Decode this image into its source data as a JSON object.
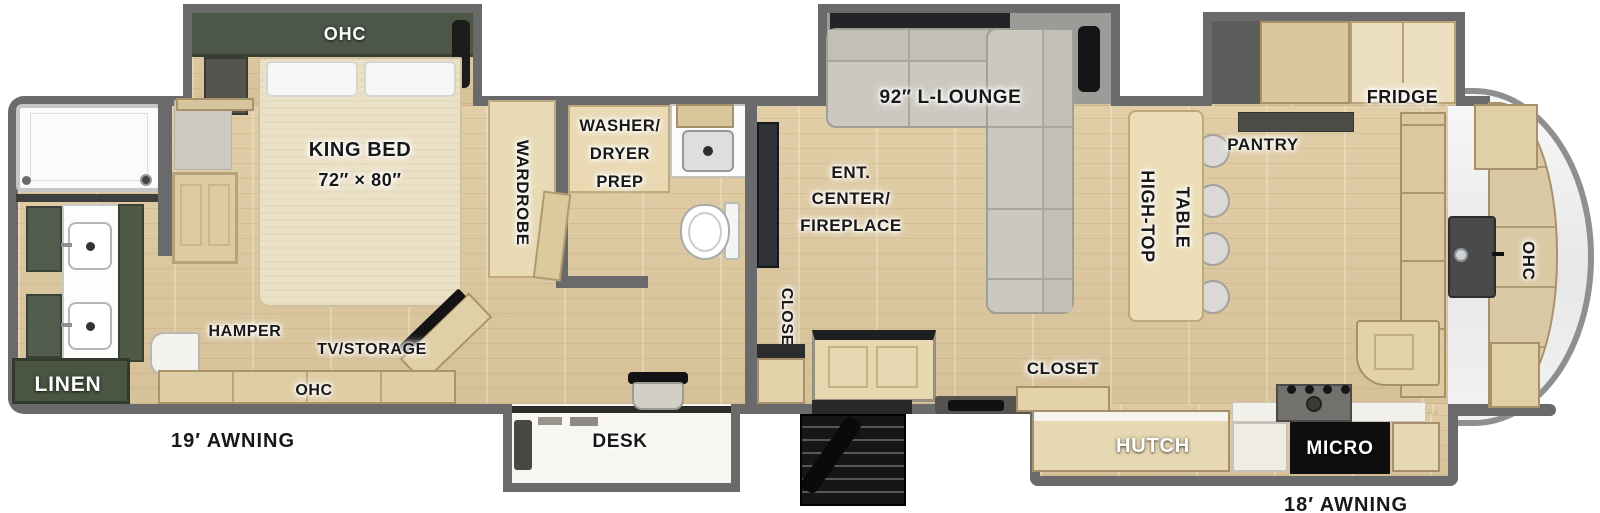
{
  "title": "RV fifth-wheel floor plan",
  "labels": {
    "bedroom_ohc": "OHC",
    "king_bed": {
      "line1": "KING BED",
      "line2": "72″ × 80″"
    },
    "wardrobe": "WARDROBE",
    "washer_dryer": {
      "line1": "WASHER/",
      "line2": "DRYER",
      "line3": "PREP"
    },
    "hamper": "HAMPER",
    "tv_storage": "TV/STORAGE",
    "ohc_bottom": "OHC",
    "linen": "LINEN",
    "awning_left": "19′ AWNING",
    "desk": "DESK",
    "closet_mid": "CLOSET",
    "ent_center": {
      "line1": "ENT.",
      "line2": "CENTER/",
      "line3": "FIREPLACE"
    },
    "l_lounge": "92″ L-LOUNGE",
    "closet_kitchen": "CLOSET",
    "high_top": {
      "line1": "HIGH-TOP",
      "line2": "TABLE"
    },
    "pantry": "PANTRY",
    "fridge": "FRIDGE",
    "hutch": "HUTCH",
    "micro": "MICRO",
    "ohc_rear": "OHC",
    "awning_right": "18′ AWNING"
  },
  "colors": {
    "wall": "#6a6a6a",
    "floor_wood": "#dcc9a2",
    "cabinet_wood": "#e3d3ab",
    "accent_green": "#4d5748",
    "sofa_gray": "#cbc8c0",
    "counter_dark": "#4b4b48",
    "label_black": "#181818",
    "label_white": "#ffffff"
  }
}
